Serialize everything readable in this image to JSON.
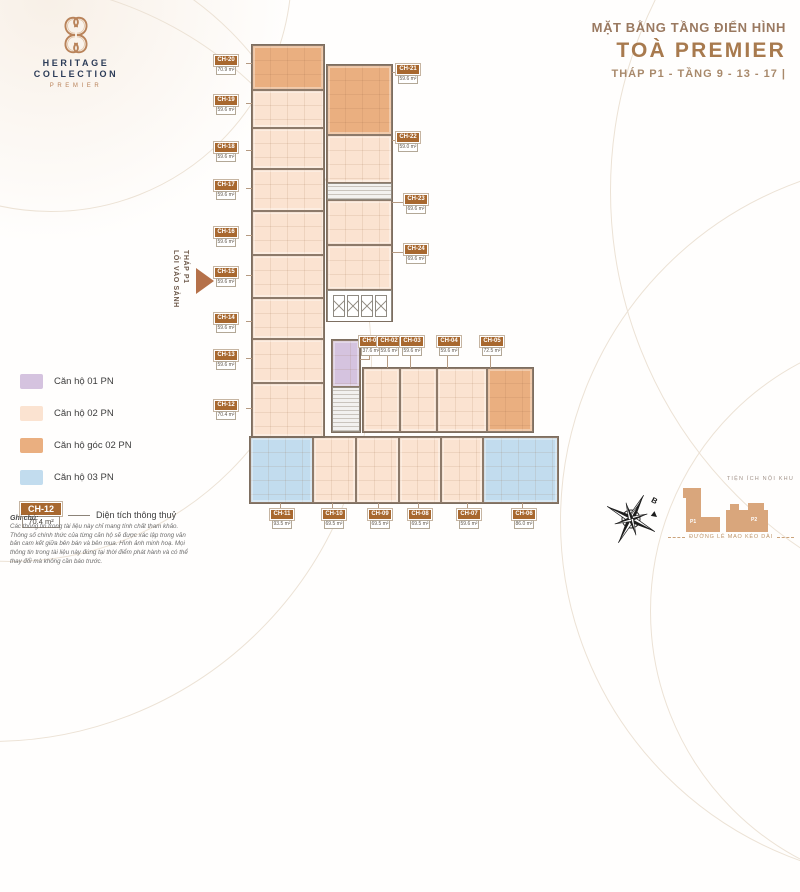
{
  "brand": {
    "monogram": "HC",
    "line1": "HERITAGE",
    "line2": "COLLECTION",
    "line3": "PREMIER"
  },
  "header": {
    "subtitle": "MẶT BẰNG TẦNG ĐIỂN HÌNH",
    "title": "TOÀ PREMIER",
    "tower_line": "THÁP P1 - TẦNG 9 - 13 - 17 |"
  },
  "entrance": {
    "line1": "LỐI VÀO SẢNH",
    "line2": "THÁP P1"
  },
  "legend": {
    "items": [
      {
        "type": "1pn",
        "label": "Căn hộ 01 PN",
        "color": "#d5c3df"
      },
      {
        "type": "2pn",
        "label": "Căn hộ 02 PN",
        "color": "#fbe3d1"
      },
      {
        "type": "2pn-goc",
        "label": "Căn hộ góc 02 PN",
        "color": "#eaaf80"
      },
      {
        "type": "3pn",
        "label": "Căn hộ 03 PN",
        "color": "#c2dcee"
      }
    ],
    "example": {
      "code": "CH-12",
      "area": "70.4 m²",
      "note": "Diện tích thông thuỷ"
    }
  },
  "units": [
    {
      "code": "CH-01",
      "area": "37.6 m²",
      "type": "1pn"
    },
    {
      "code": "CH-02",
      "area": "59.6 m²",
      "type": "2pn"
    },
    {
      "code": "CH-03",
      "area": "59.6 m²",
      "type": "2pn"
    },
    {
      "code": "CH-04",
      "area": "59.6 m²",
      "type": "2pn"
    },
    {
      "code": "CH-05",
      "area": "72.5 m²",
      "type": "2pn-goc"
    },
    {
      "code": "CH-06",
      "area": "86.0 m²",
      "type": "3pn"
    },
    {
      "code": "CH-07",
      "area": "59.6 m²",
      "type": "2pn"
    },
    {
      "code": "CH-08",
      "area": "69.5 m²",
      "type": "2pn"
    },
    {
      "code": "CH-09",
      "area": "69.5 m²",
      "type": "2pn"
    },
    {
      "code": "CH-10",
      "area": "69.5 m²",
      "type": "2pn"
    },
    {
      "code": "CH-11",
      "area": "93.5 m²",
      "type": "3pn"
    },
    {
      "code": "CH-12",
      "area": "70.4 m²",
      "type": "2pn"
    },
    {
      "code": "CH-13",
      "area": "59.6 m²",
      "type": "2pn"
    },
    {
      "code": "CH-14",
      "area": "59.6 m²",
      "type": "2pn"
    },
    {
      "code": "CH-15",
      "area": "59.6 m²",
      "type": "2pn"
    },
    {
      "code": "CH-16",
      "area": "59.6 m²",
      "type": "2pn"
    },
    {
      "code": "CH-17",
      "area": "59.6 m²",
      "type": "2pn"
    },
    {
      "code": "CH-18",
      "area": "59.6 m²",
      "type": "2pn"
    },
    {
      "code": "CH-19",
      "area": "59.6 m²",
      "type": "2pn"
    },
    {
      "code": "CH-20",
      "area": "70.9 m²",
      "type": "2pn-goc"
    },
    {
      "code": "CH-21",
      "area": "59.6 m²",
      "type": "2pn-goc"
    },
    {
      "code": "CH-22",
      "area": "59.0 m²",
      "type": "2pn"
    },
    {
      "code": "CH-23",
      "area": "69.6 m²",
      "type": "2pn"
    },
    {
      "code": "CH-24",
      "area": "69.6 m²",
      "type": "2pn"
    }
  ],
  "site_map": {
    "title": "TIỆN ÍCH NỘI KHU",
    "buildings": [
      "P1",
      "P2"
    ],
    "building_color": "#d9a67c",
    "road": "ĐƯỜNG LÊ MAO KÉO DÀI"
  },
  "compass": {
    "north_label": "B"
  },
  "footnote": {
    "title": "Ghi chú:",
    "body": "Các thông tin trong tài liệu này chỉ mang tính chất tham khảo. Thông số chính thức của từng căn hộ sẽ được xác lập trong văn bản cam kết giữa bên bán và bên mua. Hình ảnh minh hoạ. Mọi thông tin trong tài liệu này đúng tại thời điểm phát hành và có thể thay đổi mà không cần báo trước."
  }
}
